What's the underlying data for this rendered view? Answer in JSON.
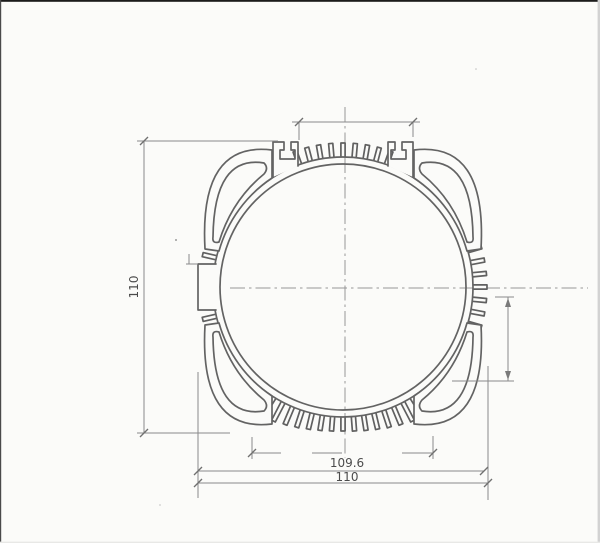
{
  "drawing": {
    "type": "technical-drawing",
    "subject": "circular finned extrusion profile cross-section",
    "dimensions": {
      "left_height": "110",
      "bottom_inner_width": "109.6",
      "bottom_outer_width": "110"
    },
    "colors": {
      "paper": "#fbfbf9",
      "ink": "#646464",
      "dimension_line": "#8a8a8a",
      "label_text": "#4c4c4c"
    }
  }
}
